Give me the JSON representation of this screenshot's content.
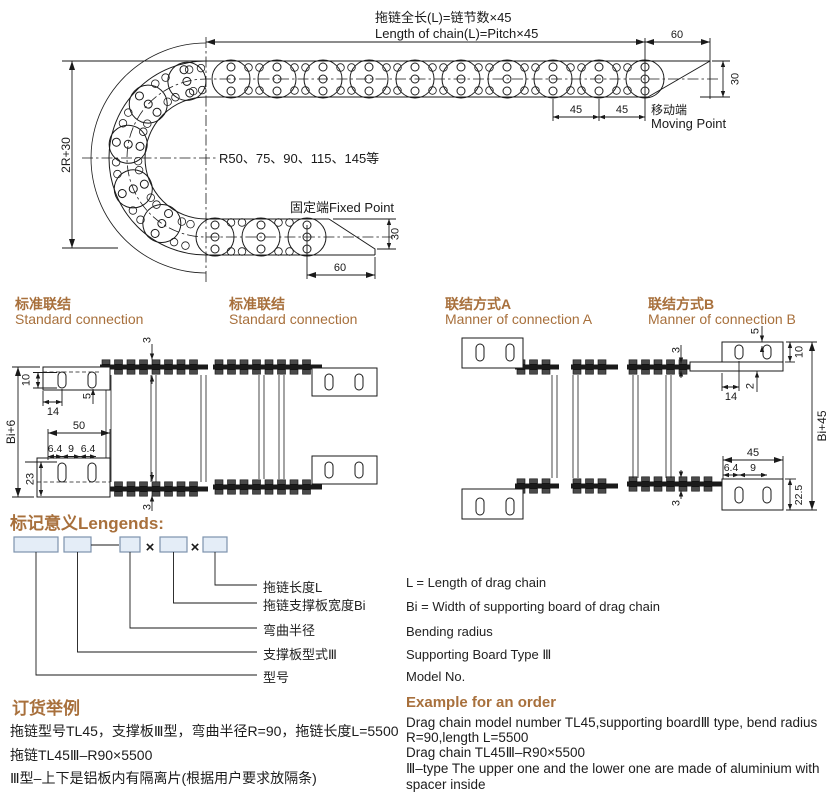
{
  "colors": {
    "accent": "#a8703c",
    "line": "#1a1a1a",
    "box_fill": "#e4edf7",
    "box_border": "#7d93ad"
  },
  "top_drawing": {
    "title_cn": "拖链全长(L)=链节数×45",
    "title_en": "Length of chain(L)=Pitch×45",
    "dim_60_top": "60",
    "dim_30_moving": "30",
    "dim_45_a": "45",
    "dim_45_b": "45",
    "moving_point_cn": "移动端",
    "moving_point_en": "Moving Point",
    "radius_note": "R50、75、90、115、145等",
    "fixed_point": "固定端Fixed Point",
    "dim_30_fixed": "30",
    "dim_60_fixed": "60",
    "dim_2r30": "2R+30"
  },
  "sections": {
    "std1_cn": "标准联结",
    "std1_en": "Standard connection",
    "std2_cn": "标准联结",
    "std2_en": "Standard connection",
    "connA_cn": "联结方式A",
    "connA_en": "Manner of connection A",
    "connB_cn": "联结方式B",
    "connB_en": "Manner of connection B"
  },
  "drawing1": {
    "dim_3_top": "3",
    "dim_10": "10",
    "dim_5": "5",
    "dim_14": "14",
    "dim_bi6": "Bi+6",
    "dim_50": "50",
    "dim_64_a": "6.4",
    "dim_9": "9",
    "dim_64_b": "6.4",
    "dim_23": "23",
    "dim_3_bottom": "3"
  },
  "drawing4": {
    "dim_5": "5",
    "dim_3_top": "3",
    "dim_10": "10",
    "dim_2": "2",
    "dim_14": "14",
    "dim_bi45": "Bi+45",
    "dim_45": "45",
    "dim_64": "6.4",
    "dim_9": "9",
    "dim_225": "22.5",
    "dim_3_bottom": "3"
  },
  "legends": {
    "heading": "标记意义Lengends:",
    "multiply": "×",
    "items_cn": [
      "拖链长度L",
      "拖链支撑板宽度Bi",
      "弯曲半径",
      "支撑板型式Ⅲ",
      "型号"
    ],
    "items_en": [
      "L = Length of drag chain",
      "Bi = Width of supporting board of drag chain",
      "Bending radius",
      "Supporting Board Type Ⅲ",
      "Model No."
    ]
  },
  "order_example": {
    "heading_cn": "订货举例",
    "lines_cn": [
      "拖链型号TL45，支撑板Ⅲ型，弯曲半径R=90，拖链长度L=5500",
      "拖链TL45Ⅲ–R90×5500",
      "Ⅲ型–上下是铝板内有隔离片(根据用户要求放隔条)"
    ],
    "heading_en": "Example for an order",
    "lines_en": [
      "Drag chain model number TL45,supporting boardⅢ type, bend radius",
      "R=90,length L=5500",
      "Drag chain TL45Ⅲ–R90×5500",
      "Ⅲ–type The upper one and the lower one are made of aluminium with",
      "spacer inside"
    ]
  }
}
